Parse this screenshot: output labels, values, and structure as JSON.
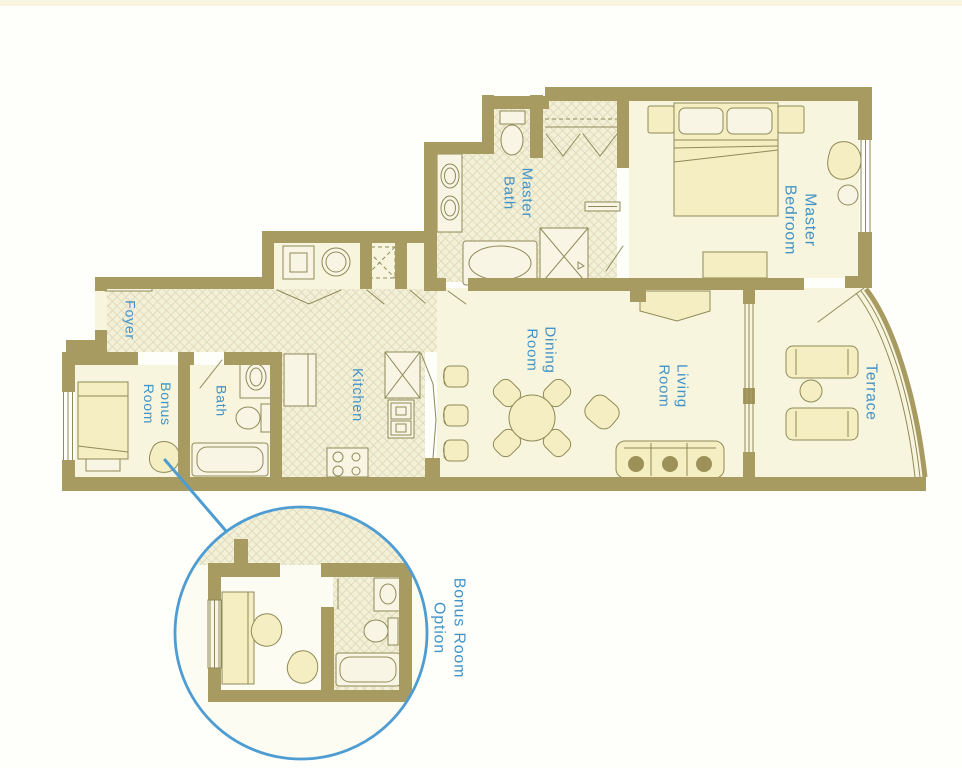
{
  "rooms": {
    "foyer": {
      "label": "Foyer"
    },
    "bonus_room": {
      "line1": "Bonus",
      "line2": "Room"
    },
    "bath": {
      "label": "Bath"
    },
    "kitchen": {
      "label": "Kitchen"
    },
    "master_bath": {
      "line1": "Master",
      "line2": "Bath"
    },
    "dining_room": {
      "line1": "Dining",
      "line2": "Room"
    },
    "living_room": {
      "line1": "Living",
      "line2": "Room"
    },
    "master_bedroom": {
      "line1": "Master",
      "line2": "Bedroom"
    },
    "terrace": {
      "label": "Terrace"
    },
    "bonus_room_option": {
      "line1": "Bonus Room",
      "line2": "Option"
    }
  },
  "colors": {
    "wall": "#a79b61",
    "floor": "#f8f5de",
    "hatch_bg": "#f3f0d8",
    "hatch_line": "#ddd8b8",
    "furniture_fill": "#f4eec2",
    "fixture_fill": "#f8f5e4",
    "outline": "#8f8a58",
    "label_blue": "#4193c8",
    "callout_blue": "#4d9cd2",
    "sofa_pillow": "#9c9259",
    "background": "#fefefb"
  }
}
